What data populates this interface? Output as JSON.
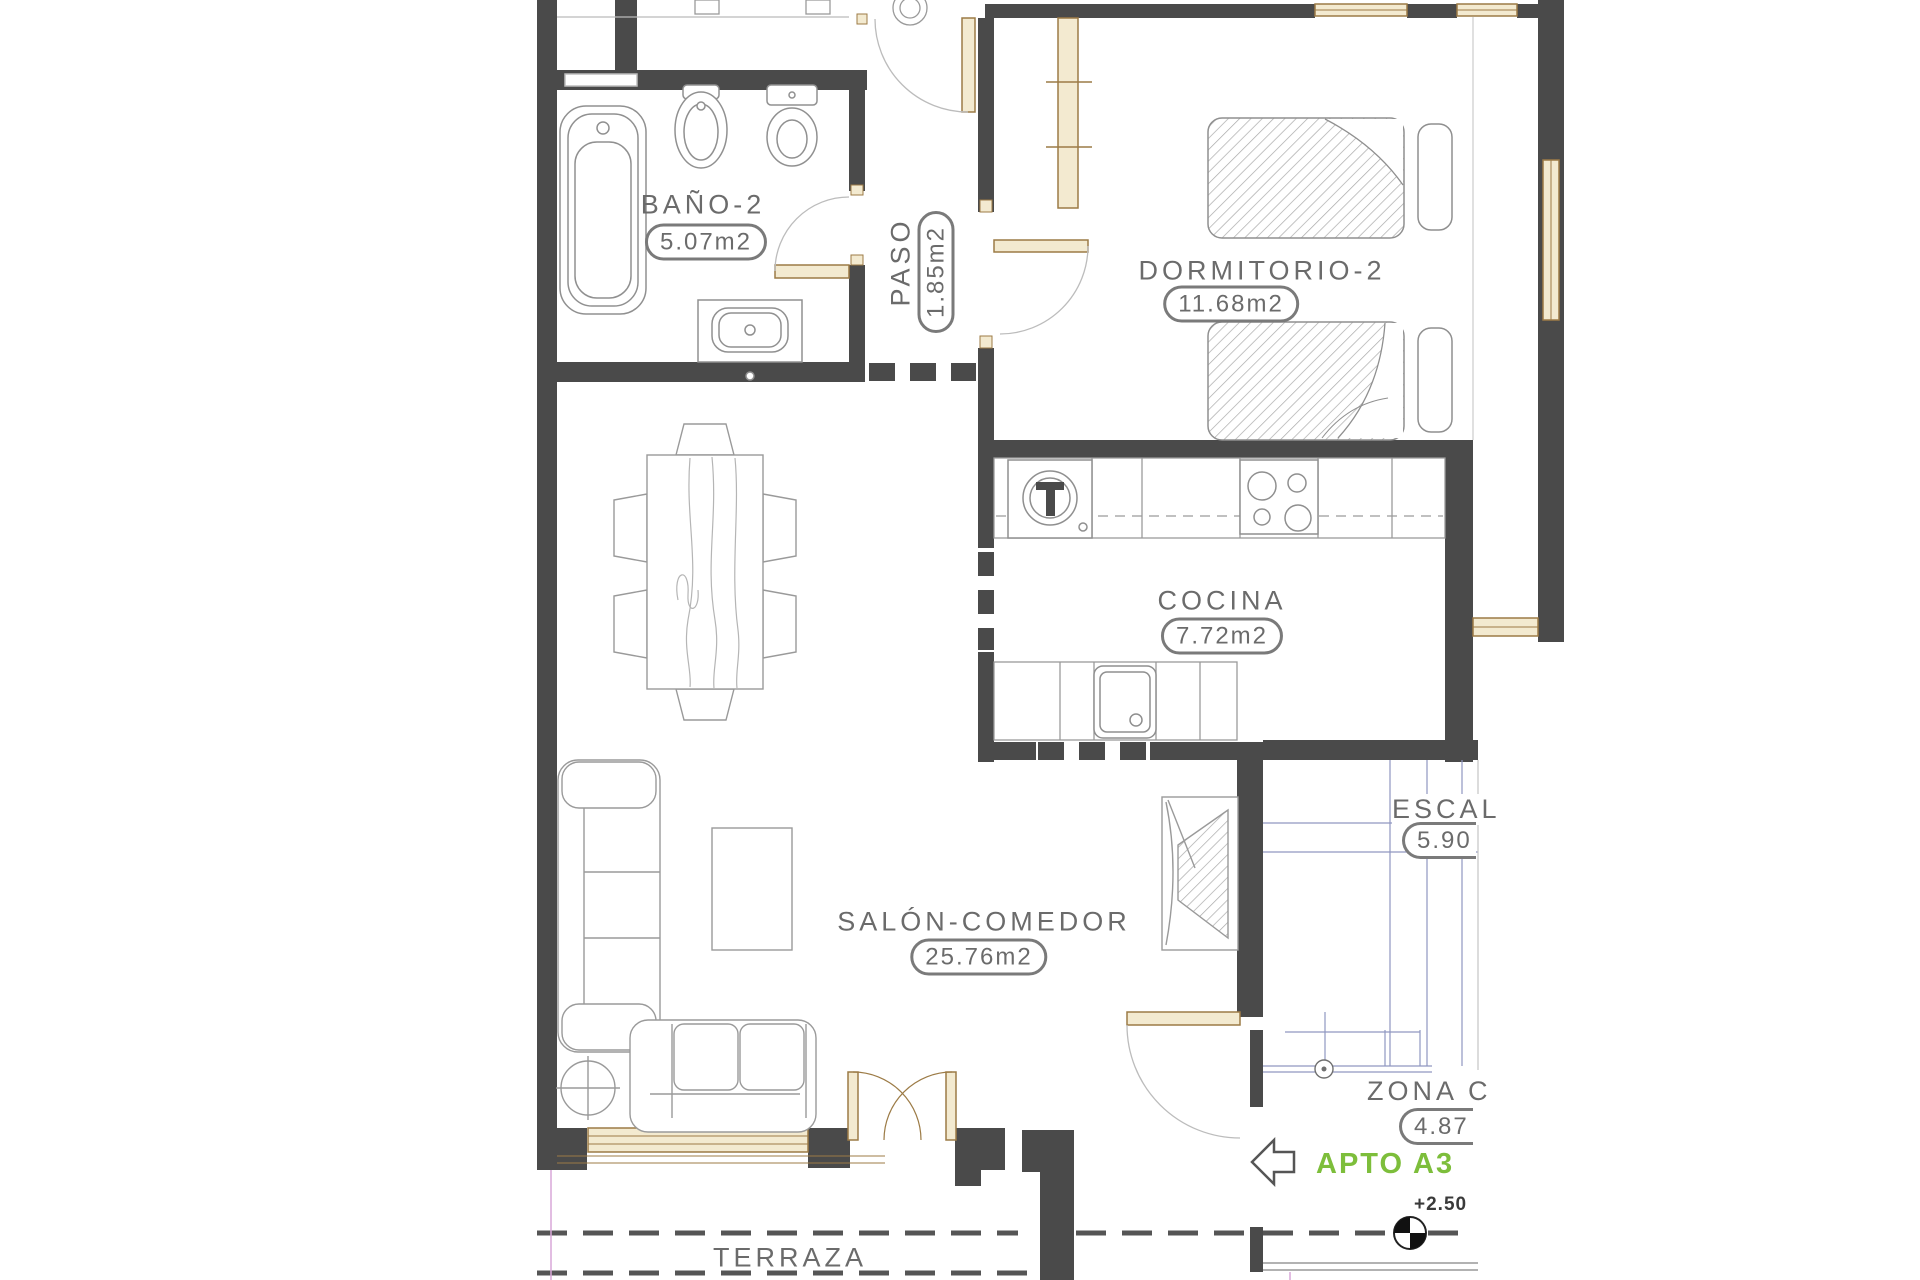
{
  "rooms": {
    "bano2": {
      "name": "BAÑO-2",
      "area": "5.07m2"
    },
    "paso": {
      "name": "PASO",
      "area": "1.85m2"
    },
    "dormitorio2": {
      "name": "DORMITORIO-2",
      "area": "11.68m2"
    },
    "cocina": {
      "name": "COCINA",
      "area": "7.72m2"
    },
    "salon_comedor": {
      "name": "SALÓN-COMEDOR",
      "area": "25.76m2"
    },
    "escalera": {
      "name": "ESCAL",
      "area": "5.90"
    },
    "zona_comun": {
      "name": "ZONA C",
      "area": "4.87"
    },
    "terraza": {
      "name": "TERRAZA"
    }
  },
  "annotations": {
    "apartment_label": "APTO A3",
    "level_mark": "+2.50"
  },
  "colors": {
    "wall": "#4a4a4a",
    "carpentry_line": "#9c7b46",
    "carpentry_fill": "#f3ead0",
    "apartment_accent": "#7dbe3b",
    "stairs_line": "#9097c0",
    "label_text": "#6b6b6b",
    "fixture_line": "#999999"
  }
}
